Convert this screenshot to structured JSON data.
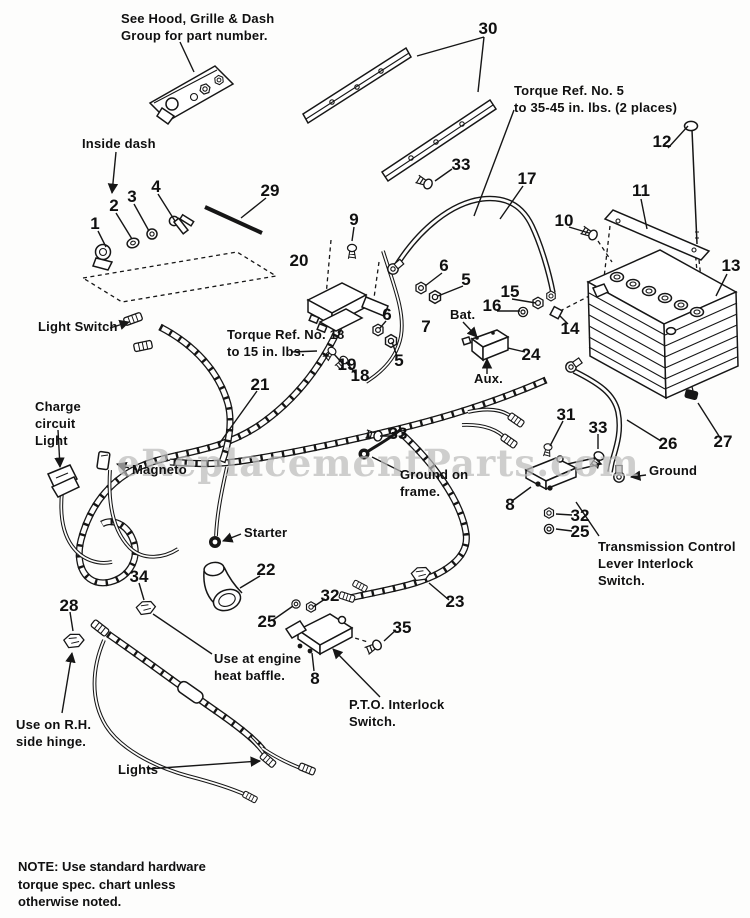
{
  "page": {
    "width": 750,
    "height": 918,
    "background": "#fdfdfc",
    "ink": "#161616",
    "watermark_color": "#bcbcbc"
  },
  "watermark": {
    "text": "eReplacementParts.com"
  },
  "note": {
    "text": "NOTE: Use standard hardware\ntorque spec. chart unless\notherwise noted."
  },
  "annotations": [
    {
      "id": "see-hood",
      "text": "See Hood, Grille & Dash\nGroup for part number.",
      "x": 121,
      "y": 10
    },
    {
      "id": "inside-dash",
      "text": "Inside dash",
      "x": 82,
      "y": 135
    },
    {
      "id": "torque-ref-5",
      "text": "Torque Ref. No. 5\nto 35-45 in. lbs. (2 places)",
      "x": 514,
      "y": 82
    },
    {
      "id": "light-switch",
      "text": "Light Switch",
      "x": 38,
      "y": 318
    },
    {
      "id": "torque-ref-18",
      "text": "Torque Ref. No. 18\nto 15 in. lbs.",
      "x": 227,
      "y": 326
    },
    {
      "id": "charge-circuit-light",
      "text": "Charge\ncircuit\nLight",
      "x": 35,
      "y": 398
    },
    {
      "id": "magneto",
      "text": "Magneto",
      "x": 132,
      "y": 461
    },
    {
      "id": "starter",
      "text": "Starter",
      "x": 244,
      "y": 524
    },
    {
      "id": "ground-on-frame",
      "text": "Ground on\nframe.",
      "x": 400,
      "y": 466
    },
    {
      "id": "bat",
      "text": "Bat.",
      "x": 450,
      "y": 306
    },
    {
      "id": "aux",
      "text": "Aux.",
      "x": 474,
      "y": 370
    },
    {
      "id": "ground",
      "text": "Ground",
      "x": 649,
      "y": 462
    },
    {
      "id": "transmission-switch",
      "text": "Transmission Control\nLever Interlock\nSwitch.",
      "x": 598,
      "y": 538
    },
    {
      "id": "heat-baffle",
      "text": "Use at engine\nheat baffle.",
      "x": 214,
      "y": 650
    },
    {
      "id": "pto-switch",
      "text": "P.T.O. Interlock\nSwitch.",
      "x": 349,
      "y": 696
    },
    {
      "id": "rh-hinge",
      "text": "Use on R.H.\nside hinge.",
      "x": 16,
      "y": 716
    },
    {
      "id": "lights",
      "text": "Lights",
      "x": 118,
      "y": 761
    }
  ],
  "callouts": [
    {
      "n": "1",
      "x": 95,
      "y": 224
    },
    {
      "n": "2",
      "x": 114,
      "y": 206
    },
    {
      "n": "3",
      "x": 132,
      "y": 197
    },
    {
      "n": "4",
      "x": 156,
      "y": 187
    },
    {
      "n": "29",
      "x": 270,
      "y": 191
    },
    {
      "n": "30",
      "x": 488,
      "y": 29
    },
    {
      "n": "33",
      "x": 461,
      "y": 165
    },
    {
      "n": "9",
      "x": 354,
      "y": 220
    },
    {
      "n": "17",
      "x": 527,
      "y": 179
    },
    {
      "n": "12",
      "x": 662,
      "y": 142
    },
    {
      "n": "11",
      "x": 641,
      "y": 191
    },
    {
      "n": "10",
      "x": 564,
      "y": 221
    },
    {
      "n": "13",
      "x": 731,
      "y": 266
    },
    {
      "n": "20",
      "x": 299,
      "y": 261
    },
    {
      "n": "6",
      "x": 444,
      "y": 266
    },
    {
      "n": "5",
      "x": 466,
      "y": 280
    },
    {
      "n": "15",
      "x": 510,
      "y": 292
    },
    {
      "n": "16",
      "x": 492,
      "y": 306
    },
    {
      "n": "14",
      "x": 570,
      "y": 329
    },
    {
      "n": "24",
      "x": 531,
      "y": 355
    },
    {
      "n": "6",
      "x": 387,
      "y": 315
    },
    {
      "n": "7",
      "x": 426,
      "y": 327
    },
    {
      "n": "5",
      "x": 399,
      "y": 361
    },
    {
      "n": "19",
      "x": 347,
      "y": 365
    },
    {
      "n": "18",
      "x": 360,
      "y": 376
    },
    {
      "n": "21",
      "x": 260,
      "y": 385
    },
    {
      "n": "33",
      "x": 398,
      "y": 434
    },
    {
      "n": "31",
      "x": 566,
      "y": 415
    },
    {
      "n": "33",
      "x": 598,
      "y": 428
    },
    {
      "n": "26",
      "x": 668,
      "y": 444
    },
    {
      "n": "27",
      "x": 723,
      "y": 442
    },
    {
      "n": "8",
      "x": 510,
      "y": 505
    },
    {
      "n": "32",
      "x": 580,
      "y": 516
    },
    {
      "n": "25",
      "x": 580,
      "y": 532
    },
    {
      "n": "22",
      "x": 266,
      "y": 570
    },
    {
      "n": "34",
      "x": 139,
      "y": 577
    },
    {
      "n": "28",
      "x": 69,
      "y": 606
    },
    {
      "n": "32",
      "x": 330,
      "y": 596
    },
    {
      "n": "25",
      "x": 267,
      "y": 622
    },
    {
      "n": "35",
      "x": 402,
      "y": 628
    },
    {
      "n": "23",
      "x": 455,
      "y": 602
    },
    {
      "n": "8",
      "x": 315,
      "y": 679
    }
  ]
}
